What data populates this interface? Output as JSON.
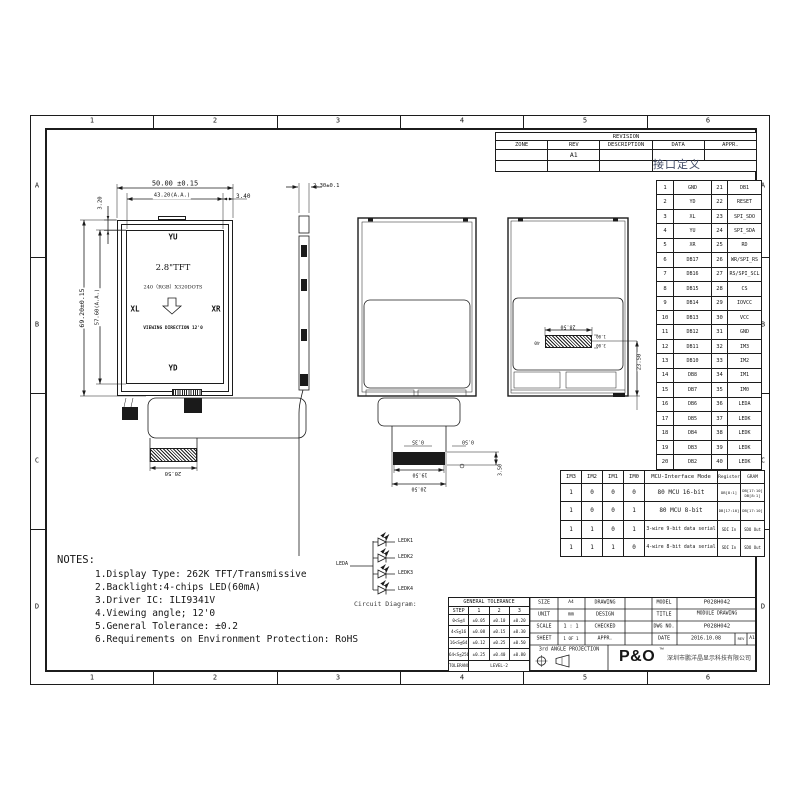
{
  "sheet": {
    "zone_cols": [
      "1",
      "2",
      "3",
      "4",
      "5",
      "6"
    ],
    "zone_rows": [
      "A",
      "B",
      "C",
      "D"
    ]
  },
  "revision": {
    "title": "REVISION",
    "h_zone": "ZONE",
    "h_rev": "REV",
    "h_desc": "DESCRIPTION",
    "h_data": "DATA",
    "h_appr": "APPR.",
    "rev_value": "A1",
    "annotation_cn": "接口定义"
  },
  "pins": {
    "rows": [
      {
        "n1": "1",
        "s1": "GND",
        "n2": "21",
        "s2": "DB1"
      },
      {
        "n1": "2",
        "s1": "YD",
        "n2": "22",
        "s2": "RESET"
      },
      {
        "n1": "3",
        "s1": "XL",
        "n2": "23",
        "s2": "SPI_SDO"
      },
      {
        "n1": "4",
        "s1": "YU",
        "n2": "24",
        "s2": "SPI_SDA"
      },
      {
        "n1": "5",
        "s1": "XR",
        "n2": "25",
        "s2": "RD"
      },
      {
        "n1": "6",
        "s1": "DB17",
        "n2": "26",
        "s2": "WR/SPI_RS"
      },
      {
        "n1": "7",
        "s1": "DB16",
        "n2": "27",
        "s2": "RS/SPI_SCL"
      },
      {
        "n1": "8",
        "s1": "DB15",
        "n2": "28",
        "s2": "CS"
      },
      {
        "n1": "9",
        "s1": "DB14",
        "n2": "29",
        "s2": "IOVCC"
      },
      {
        "n1": "10",
        "s1": "DB13",
        "n2": "30",
        "s2": "VCC"
      },
      {
        "n1": "11",
        "s1": "DB12",
        "n2": "31",
        "s2": "GND"
      },
      {
        "n1": "12",
        "s1": "DB11",
        "n2": "32",
        "s2": "IM3"
      },
      {
        "n1": "13",
        "s1": "DB10",
        "n2": "33",
        "s2": "IM2"
      },
      {
        "n1": "14",
        "s1": "DB8",
        "n2": "34",
        "s2": "IM1"
      },
      {
        "n1": "15",
        "s1": "DB7",
        "n2": "35",
        "s2": "IM0"
      },
      {
        "n1": "16",
        "s1": "DB6",
        "n2": "36",
        "s2": "LEDA"
      },
      {
        "n1": "17",
        "s1": "DB5",
        "n2": "37",
        "s2": "LEDK"
      },
      {
        "n1": "18",
        "s1": "DB4",
        "n2": "38",
        "s2": "LEDK"
      },
      {
        "n1": "19",
        "s1": "DB3",
        "n2": "39",
        "s2": "LEDK"
      },
      {
        "n1": "20",
        "s1": "DB2",
        "n2": "40",
        "s2": "LEDK"
      }
    ]
  },
  "mcu_table": {
    "h_im3": "IM3",
    "h_im2": "IM2",
    "h_im1": "IM1",
    "h_im0": "IM0",
    "h_mode": "MCU-Interface Mode",
    "h_reg": "Register",
    "h_gram": "GRAM",
    "rows": [
      {
        "im3": "1",
        "im2": "0",
        "im1": "0",
        "im0": "0",
        "mode": "80 MCU 16-bit",
        "reg": "DB[8:1]",
        "gram1": "DB[17:10]",
        "gram2": "DB[8:1]"
      },
      {
        "im3": "1",
        "im2": "0",
        "im1": "0",
        "im0": "1",
        "mode": "80 MCU 8-bit",
        "reg": "DB[17:10]",
        "gram1": "DB[17:10]",
        "gram2": ""
      },
      {
        "im3": "1",
        "im2": "1",
        "im1": "0",
        "im0": "1",
        "mode": "3-wire 9-bit data serial",
        "reg": "SDI In",
        "gram1": "SDO Out",
        "gram2": ""
      },
      {
        "im3": "1",
        "im2": "1",
        "im1": "1",
        "im0": "0",
        "mode": "4-wire 8-bit data serial",
        "reg": "SDI In",
        "gram1": "SDO Out",
        "gram2": ""
      }
    ]
  },
  "front_view": {
    "dim_width": "50.00 ±0.15",
    "dim_aa_width": "43.20(A.A.)",
    "dim_edge_right": "3.40",
    "dim_edge_top": "3.20",
    "dim_height": "69.20±0.15",
    "dim_aa_height": "57.60(A.A.)",
    "label_top": "YU",
    "label_left": "XL",
    "label_right": "XR",
    "label_bottom": "YD",
    "line1": "2.8\"TFT",
    "line2": "240（RGB）X320DOTS",
    "line3": "VIEWING DIRECTION 12'0",
    "dim_fpc": "20.50"
  },
  "side_view": {
    "dim_thickness": "2.30±0.1"
  },
  "rear_view": {
    "dim_a": "0.35",
    "dim_b": "0.50",
    "dim_c": "19.50",
    "dim_d": "20.50",
    "dim_e": "3.50"
  },
  "rear_view2": {
    "dim_pad_w": "28.50",
    "dim_pin": "40",
    "dim_s1": "1.00",
    "dim_s2": "3.00",
    "dim_offset": "23.50"
  },
  "led_circuit": {
    "caption": "Circuit Diagram:",
    "anode": "LEDA",
    "k": [
      "LEDK1",
      "LEDK2",
      "LEDK3",
      "LEDK4"
    ]
  },
  "notes": {
    "title": "NOTES:",
    "items": [
      "1.Display Type: 262K TFT/Transmissive",
      "2.Backlight:4-chips LED(60mA)",
      "3.Driver IC: ILI9341V",
      "4.Viewing angle;  12'0",
      "5.General Tolerance: ±0.2",
      "6.Requirements on Environment Protection: RoHS"
    ]
  },
  "tolerance_table": {
    "title": "GENERAL TOLERANCE",
    "h_step": "STEP",
    "h1": "1",
    "h2": "2",
    "h3": "3",
    "rows": [
      {
        "step": "0<S≦4",
        "t1": "±0.05",
        "t2": "±0.10",
        "t3": "±0.20"
      },
      {
        "step": "4<S≦16",
        "t1": "±0.08",
        "t2": "±0.15",
        "t3": "±0.30"
      },
      {
        "step": "16<S≦64",
        "t1": "±0.12",
        "t2": "±0.25",
        "t3": "±0.50"
      },
      {
        "step": "64<S≦256",
        "t1": "±0.25",
        "t2": "±0.40",
        "t3": "±0.80"
      }
    ],
    "f_label": "TOLERANCE",
    "f_value": "LEVEL-2"
  },
  "info_table": {
    "r0k": "SIZE",
    "r0v": "A4",
    "r0r": "DRAWING",
    "r1k": "UNIT",
    "r1v": "mm",
    "r1r": "DESIGN",
    "r2k": "SCALE",
    "r2v": "1 : 1",
    "r2r": "CHECKED",
    "r3k": "SHEET",
    "r3v": "1 OF 1",
    "r3r": "APPR.",
    "projection": "3rd ANGLE PROJECTION"
  },
  "model_table": {
    "r0k": "MODEL",
    "r0v": "P028H042",
    "r1k": "TITLE",
    "r1v": "MODULE DRAWING",
    "r2k": "DWG NO.",
    "r2v": "P028H042",
    "date_label": "DATE",
    "date_value": "2016.10.08",
    "rev_label": "REV",
    "rev_value": "A1",
    "logo": "P&O",
    "logo_tm": "™",
    "company": "深圳市鹏洋晶显示科技有限公司"
  },
  "colors": {
    "line": "#1c1c1c",
    "bg": "#ffffff",
    "stamp": "#3f4a66"
  }
}
